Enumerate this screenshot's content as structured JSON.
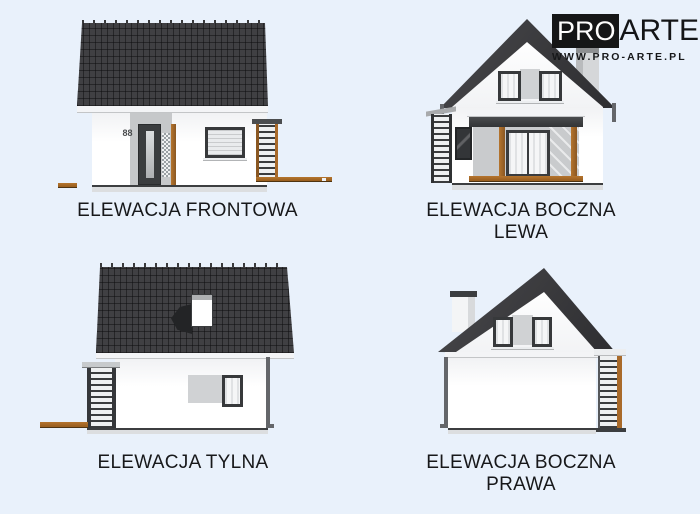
{
  "page": {
    "background": "#e9f1fb"
  },
  "logo": {
    "pro": "PRO",
    "arte": "ARTE",
    "website": "WWW.PRO-ARTE.PL"
  },
  "elevations": {
    "front": {
      "label": "ELEWACJA FRONTOWA",
      "house_number": "88"
    },
    "left": {
      "label_line1": "ELEWACJA BOCZNA",
      "label_line2": "LEWA"
    },
    "rear": {
      "label": "ELEWACJA TYLNA"
    },
    "right": {
      "label_line1": "ELEWACJA BOCZNA",
      "label_line2": "PRAWA"
    }
  },
  "colors": {
    "background": "#e9f1fb",
    "roof": "#404043",
    "wall": "#ffffff",
    "wood": "#a96a2a",
    "window_frame": "#37393b",
    "text": "#17181a",
    "logo_black": "#151617"
  }
}
